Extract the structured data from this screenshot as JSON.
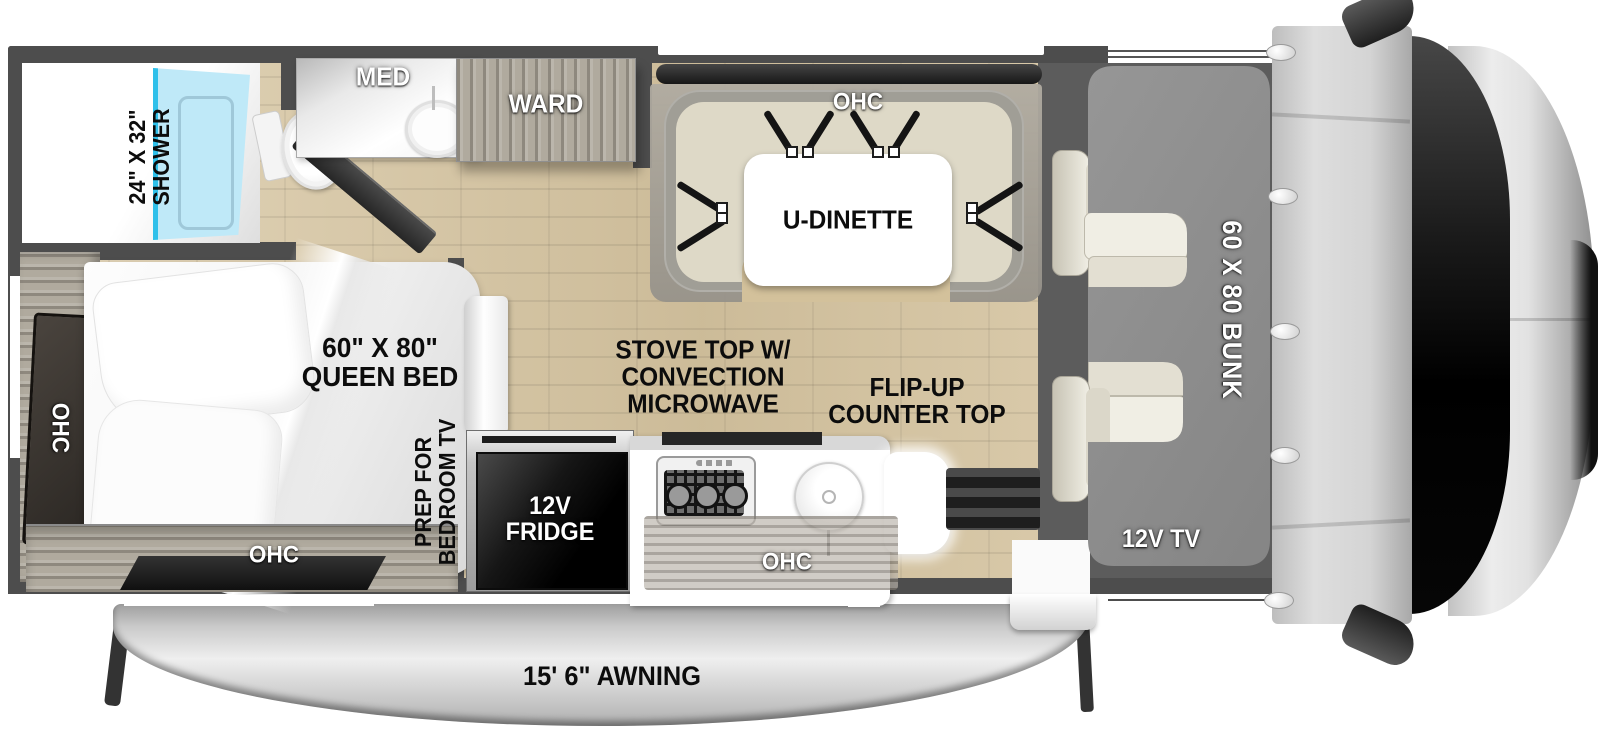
{
  "figure": {
    "type": "rv-floorplan",
    "view": "top-down",
    "vehicle_class": "Class C motorhome"
  },
  "labels": {
    "shower_dim": "24\" X 32\"",
    "shower": "SHOWER",
    "med": "MED",
    "ward": "WARD",
    "ohc_dinette": "OHC",
    "u_dinette": "U-DINETTE",
    "bed_dim": "60\" X 80\"",
    "bed": "QUEEN BED",
    "ohc_bed_left": "OHC",
    "ohc_bed_bottom": "OHC",
    "prep_1": "PREP FOR",
    "prep_2": "BEDROOM TV",
    "stove_1": "STOVE TOP W/",
    "stove_2": "CONVECTION",
    "stove_3": "MICROWAVE",
    "flip_1": "FLIP-UP",
    "flip_2": "COUNTER TOP",
    "fridge_1": "12V",
    "fridge_2": "FRIDGE",
    "ohc_kitchen": "OHC",
    "bunk": "60 X 80 BUNK",
    "tv": "12V TV",
    "awning": "15' 6\" AWNING"
  },
  "colors": {
    "wall": "#4d4d4d",
    "floor_wood": "#d9c7a2",
    "shower_blue": "#bfe9f8",
    "shower_accent": "#2fc0ea",
    "bunk_gray": "#8e8e8e",
    "cushion_beige": "#ded9c7",
    "cab_floor": "#5c5c5c",
    "awning_gray": "#c9c9c9",
    "fridge_black": "#0a0a0a"
  }
}
